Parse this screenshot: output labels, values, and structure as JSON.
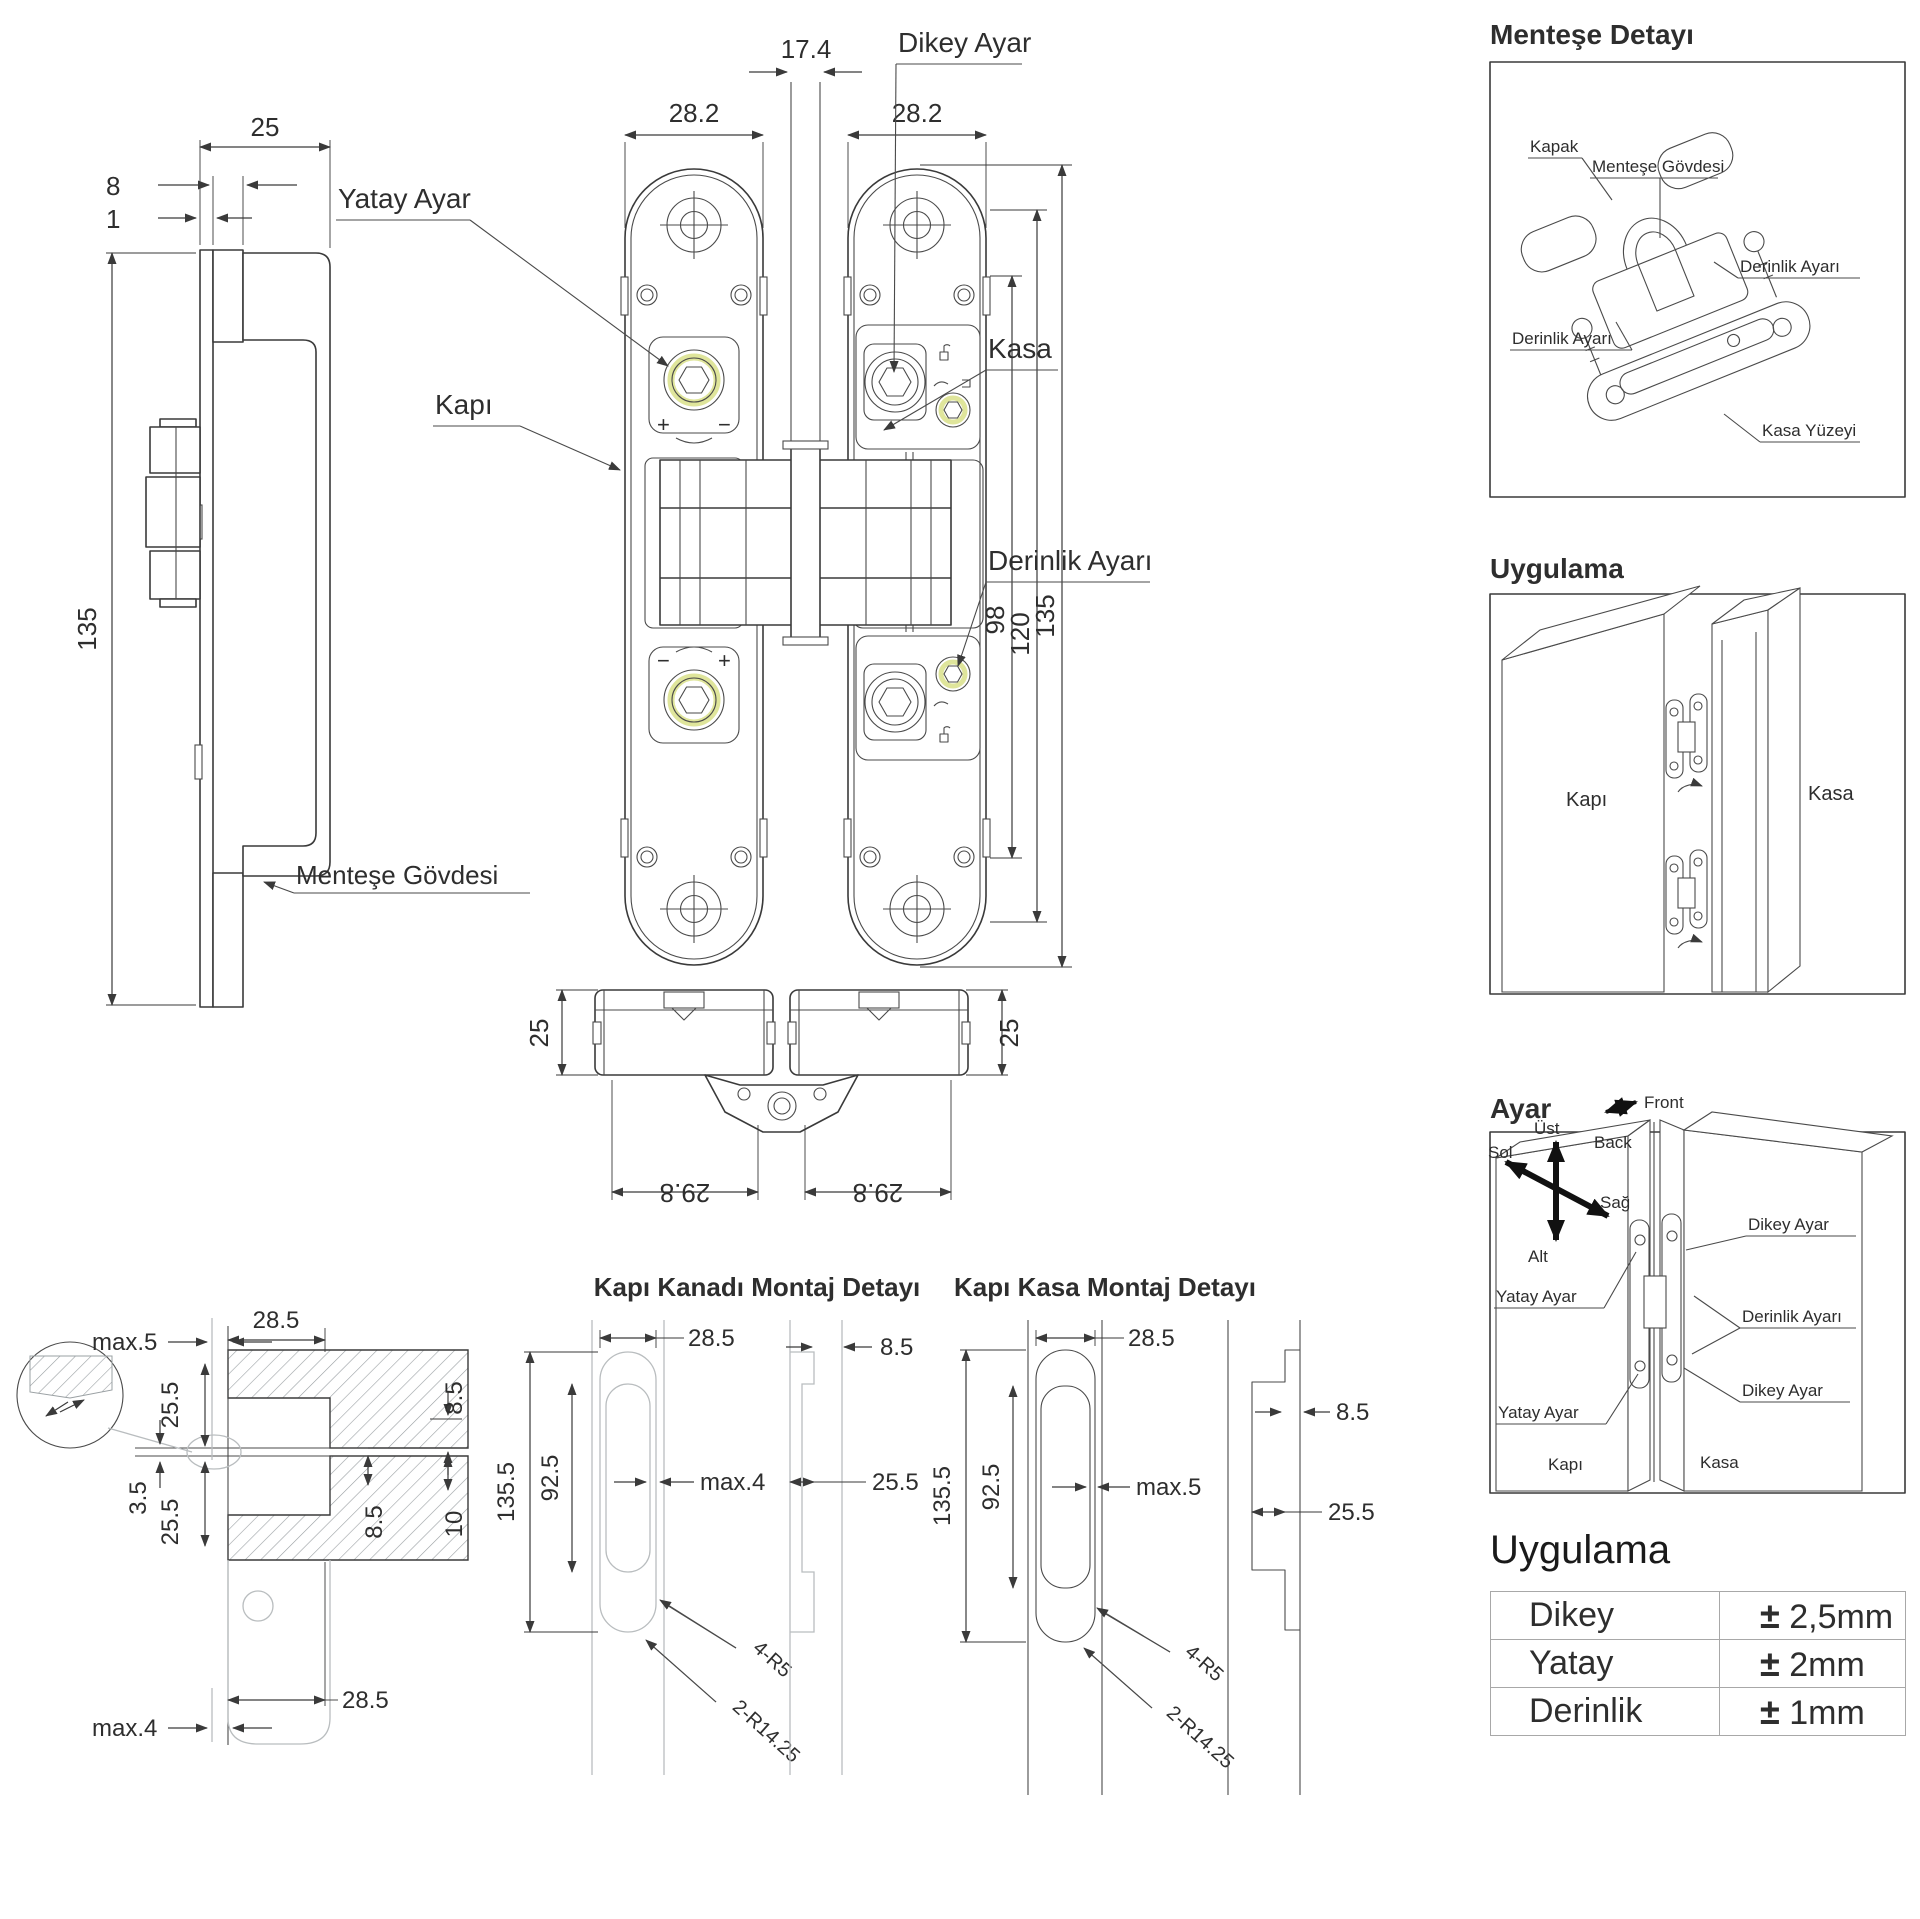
{
  "colors": {
    "line": "#3a3a3a",
    "light_line": "#b9bdbf",
    "hatch": "#9aa0a3",
    "accent_yellow": "#dfe59b"
  },
  "side_view": {
    "d25": "25",
    "d8": "8",
    "d1": "1",
    "d135": "135",
    "body_label": "Menteşe Gövdesi"
  },
  "front_view": {
    "d17_4": "17.4",
    "d28_2_l": "28.2",
    "d28_2_r": "28.2",
    "d98": "98",
    "d120": "120",
    "d135": "135",
    "lbl_dikey": "Dikey Ayar",
    "lbl_yatay": "Yatay Ayar",
    "lbl_kapi": "Kapı",
    "lbl_kasa": "Kasa",
    "lbl_derinlik": "Derinlik Ayarı",
    "plus": "+",
    "minus": "−"
  },
  "top_view": {
    "d25_l": "25",
    "d25_r": "25",
    "d29_8_l": "29.8",
    "d29_8_r": "29.8"
  },
  "cross_section": {
    "d28_5_top": "28.5",
    "max5": "max.5",
    "d25_5_a": "25.5",
    "d3_5": "3.5",
    "d25_5_b": "25.5",
    "max4": "max.4",
    "d8_5_a": "8.5",
    "d8_5_b": "8.5",
    "d10": "10",
    "d28_5_bottom": "28.5"
  },
  "leaf_detail": {
    "title": "Kapı Kanadı Montaj Detayı",
    "d28_5": "28.5",
    "d135_5": "135.5",
    "d92_5": "92.5",
    "max4": "max.4",
    "r5": "4-R5",
    "r14": "2-R14.25",
    "d8_5": "8.5",
    "d25_5": "25.5"
  },
  "frame_detail": {
    "title": "Kapı Kasa Montaj Detayı",
    "d28_5": "28.5",
    "d135_5": "135.5",
    "d92_5": "92.5",
    "max5": "max.5",
    "r5": "4-R5",
    "r14": "2-R14.25",
    "d8_5": "8.5",
    "d25_5": "25.5"
  },
  "hinge_detail_panel": {
    "title": "Menteşe Detayı",
    "kapak": "Kapak",
    "govde": "Menteşe Gövdesi",
    "derinlik_r": "Derinlik Ayarı",
    "derinlik_l": "Derinlik Ayarı",
    "kasa_yuzeyi": "Kasa Yüzeyi"
  },
  "application_panel": {
    "title": "Uygulama",
    "kapi": "Kapı",
    "kasa": "Kasa"
  },
  "adjustment_panel": {
    "title": "Ayar",
    "front": "Front",
    "back": "Back",
    "ust": "Üst",
    "sol": "Sol",
    "sag": "Sağ",
    "alt": "Alt",
    "dikey_top": "Dikey Ayar",
    "yatay_top": "Yatay Ayar",
    "derinlik": "Derinlik Ayarı",
    "dikey_bottom": "Dikey Ayar",
    "yatay_bottom": "Yatay Ayar",
    "kapi": "Kapı",
    "kasa": "Kasa"
  },
  "tolerance_table": {
    "title": "Uygulama",
    "rows": [
      {
        "label": "Dikey",
        "pm": "±",
        "value": "2,5mm"
      },
      {
        "label": "Yatay",
        "pm": "±",
        "value": "2mm"
      },
      {
        "label": "Derinlik",
        "pm": "±",
        "value": "1mm"
      }
    ]
  }
}
